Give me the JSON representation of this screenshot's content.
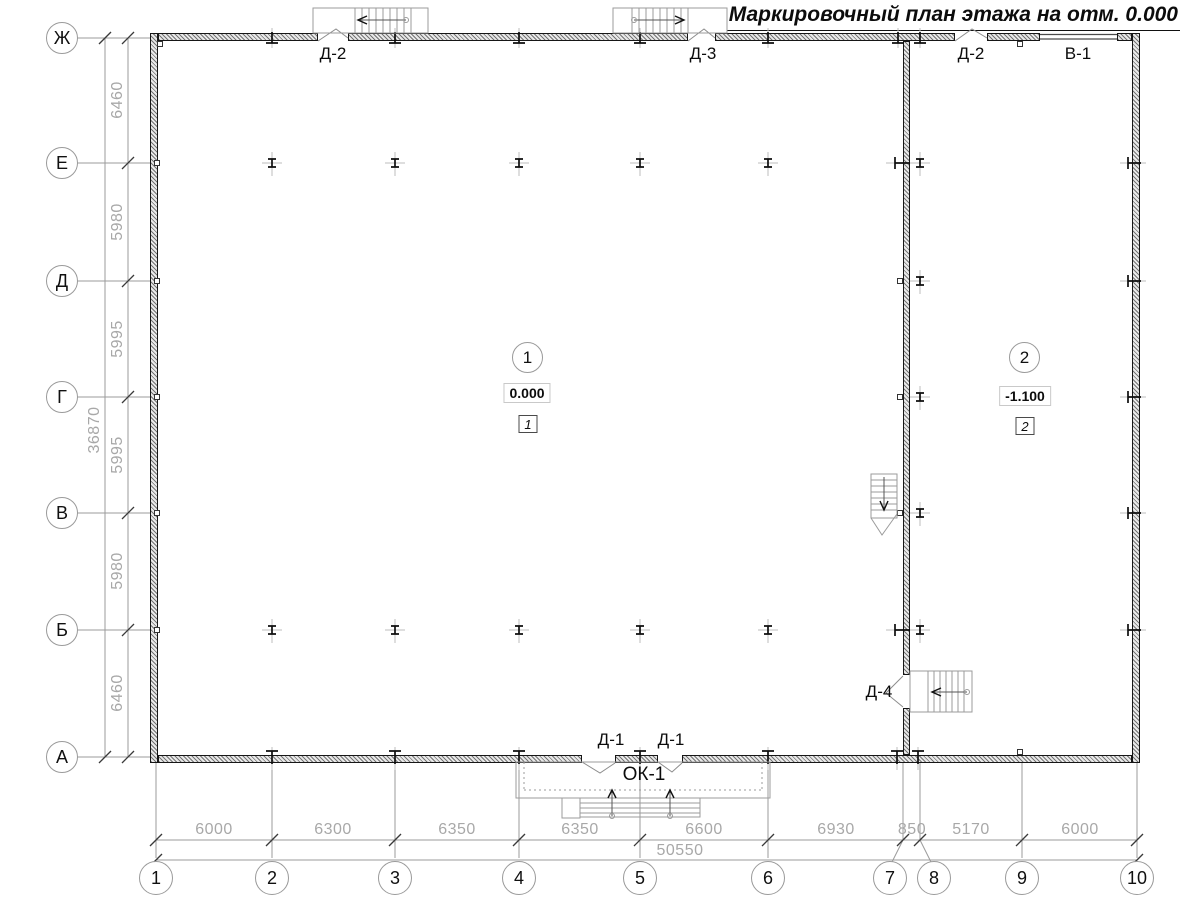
{
  "title": "Маркировочный план этажа на отм. 0.000",
  "axes": {
    "rows": [
      "Ж",
      "Е",
      "Д",
      "Г",
      "В",
      "Б",
      "А"
    ],
    "cols": [
      "1",
      "2",
      "3",
      "4",
      "5",
      "6",
      "7",
      "8",
      "9",
      "10"
    ],
    "left_dims": [
      "6460",
      "5980",
      "5995",
      "5995",
      "5980",
      "6460"
    ],
    "left_total": "36870",
    "bottom_dims": [
      "6000",
      "6300",
      "6350",
      "6350",
      "6600",
      "6930",
      "850",
      "5170",
      "6000"
    ],
    "bottom_total": "50550"
  },
  "doors": {
    "d2_left": "Д-2",
    "d3": "Д-3",
    "d2_right": "Д-2",
    "v1": "В-1",
    "d1_left": "Д-1",
    "d1_right": "Д-1",
    "ok1": "ОК-1",
    "d4": "Д-4"
  },
  "rooms": [
    {
      "number": "1",
      "elevation": "0.000",
      "zone": "1"
    },
    {
      "number": "2",
      "elevation": "-1.100",
      "zone": "2"
    }
  ]
}
